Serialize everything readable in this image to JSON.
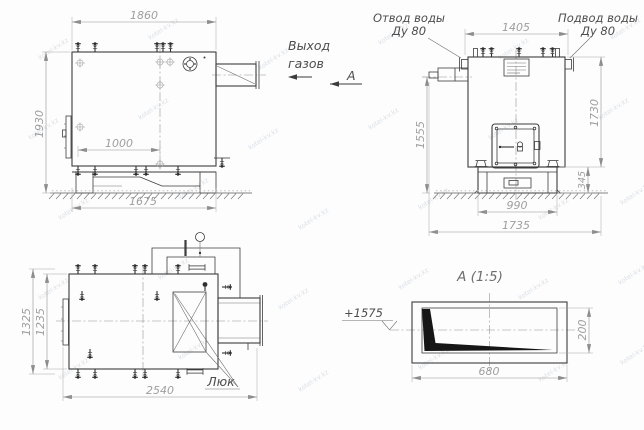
{
  "watermark": {
    "text": "kotel-kv.kz"
  },
  "labels": {
    "gas_exit_line1": "Выход",
    "gas_exit_line2": "газов",
    "section_marker": "А",
    "water_outlet_line1": "Отвод воды",
    "water_outlet_line2": "Ду 80",
    "water_supply_line1": "Подвод воды",
    "water_supply_line2": "Ду 80",
    "hatch": "Люк",
    "section_title": "А (1:5)",
    "elevation_mark": "+1575"
  },
  "dimensions": {
    "side_view": {
      "top_width": "1860",
      "overall_height": "1930",
      "drain_spacing": "1000",
      "frame_length": "1675"
    },
    "front_view": {
      "top_width": "1405",
      "burner_axis_height": "1555",
      "body_height": "1730",
      "support_height": "345",
      "support_width": "990",
      "overall_width": "1735"
    },
    "plan_view": {
      "overall_depth": "1325",
      "body_depth": "1235",
      "overall_length": "2540"
    },
    "section_a": {
      "duct_height": "200",
      "duct_width": "680"
    }
  },
  "colors": {
    "line": "#3c3c3c",
    "dimension": "#939393",
    "dimension_text": "#9e9e9e",
    "label_text": "#4d4d4d",
    "watermark": "#ccd3db",
    "background": "#fdfdfd"
  }
}
